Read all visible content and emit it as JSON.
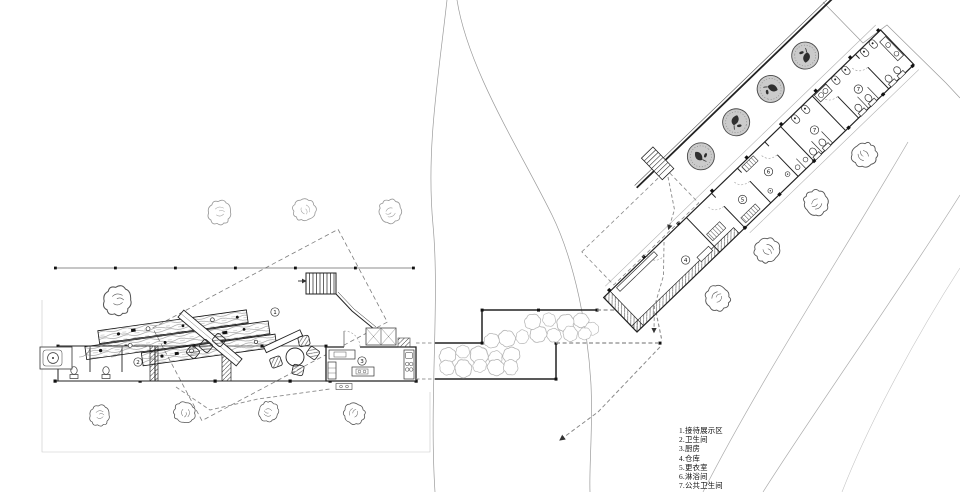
{
  "legend": {
    "items": [
      "1.接待展示区",
      "2.卫生间",
      "3.厨房",
      "4.仓库",
      "5.更衣室",
      "6.淋浴间",
      "7.公共卫生间"
    ]
  },
  "plan": {
    "rooms": {
      "n1": "1",
      "n2": "2",
      "n3": "3",
      "n4": "4",
      "n5": "5",
      "n6": "6",
      "n7a": "7",
      "n7b": "7"
    }
  },
  "colors": {
    "ink": "#1f1f1f",
    "medium_line": "#555555",
    "light_line": "#999999",
    "faint_line": "#bdbdbd",
    "tree_fill": "#cbcbcb",
    "paper": "#ffffff"
  }
}
